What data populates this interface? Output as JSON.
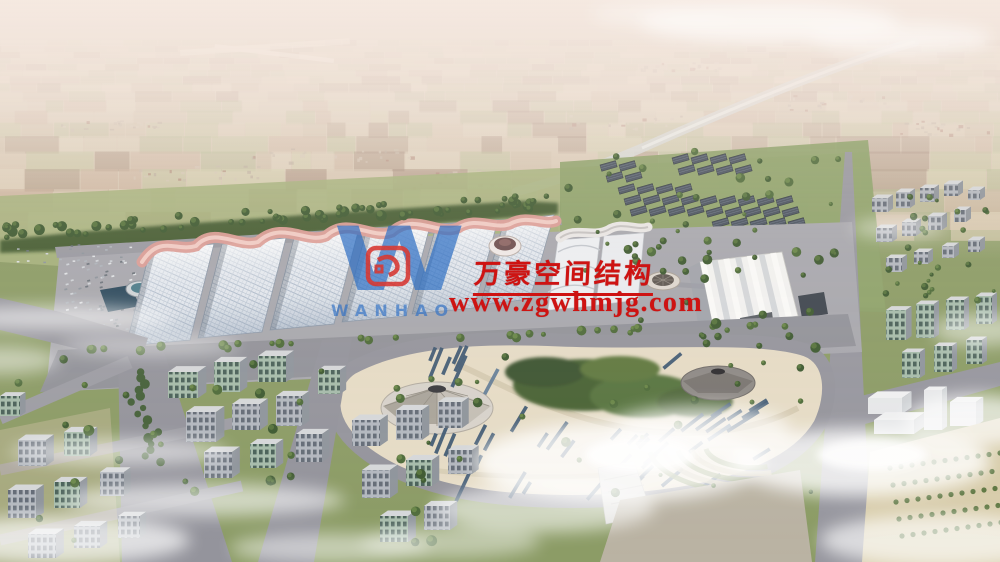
{
  "image": {
    "type": "aerial-architectural-rendering",
    "subject": "Exhibition center campus with wave-form membrane roofs, central landscaped park, surrounding city blocks, canal and farmland stretching to a hazy horizon",
    "width_px": 1000,
    "height_px": 562
  },
  "watermark": {
    "logo_letter": "W",
    "logo_subtext": "WANHAO",
    "company_name": "万豪空间结构",
    "website": "www.zgwhmjg.com",
    "colors": {
      "text_red": "#ce1312",
      "logo_blue": "#2e6fc4",
      "emblem_red": "#d6231c"
    }
  },
  "scene_palette": {
    "membrane_pink": "#dc9d96",
    "gridshell_roof": "#e9edf2",
    "park_sand": "#e6dcc6",
    "grass_green": "#8c9c66",
    "road_gray": "#97979f",
    "pond_water": "#2e4b5e",
    "shed_dark": "#49525e",
    "haze": "#f6ece6",
    "cloud_white": "#ffffff"
  }
}
